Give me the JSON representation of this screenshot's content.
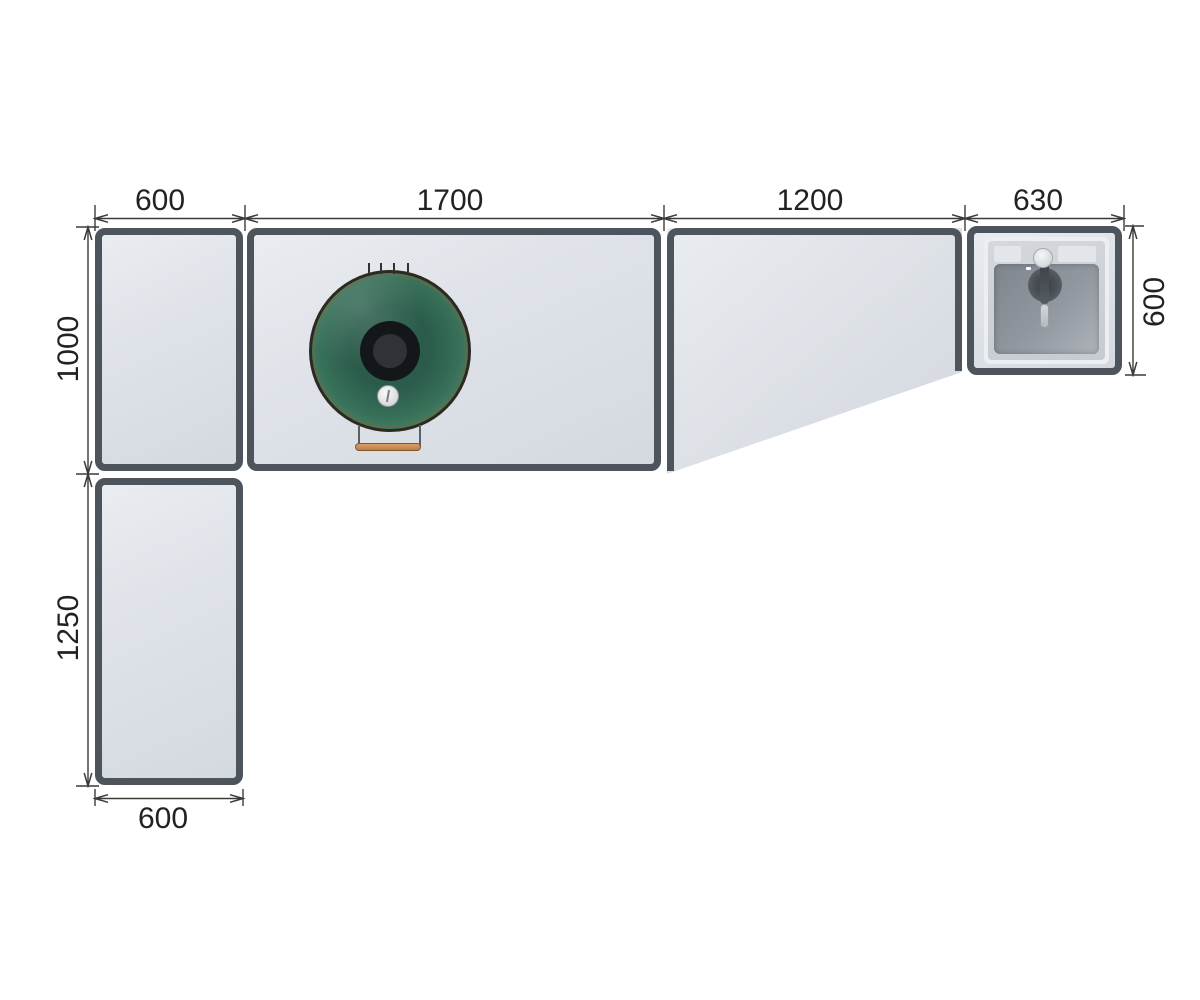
{
  "drawing": {
    "type": "outdoor-kitchen-plan-top-view",
    "background": "#ffffff",
    "dim_line_color": "#3a3a3a",
    "frame_color": "#4d545c",
    "surface_color": "#dfe3e9",
    "dimensions": {
      "top_corner_width": "600",
      "top_grill_module_width": "1700",
      "top_worktop_module_width": "1200",
      "top_sink_module_width": "630",
      "left_main_depth": "1000",
      "left_return_length": "1250",
      "right_sink_depth": "600",
      "bottom_return_width": "600"
    },
    "modules": [
      {
        "name": "corner cabinet",
        "width": "600",
        "depth": "1000"
      },
      {
        "name": "grill cabinet",
        "width": "1700",
        "depth": "1000",
        "appliance": "kamado grill"
      },
      {
        "name": "tapered worktop module",
        "width": "1200"
      },
      {
        "name": "sink cabinet",
        "width": "630",
        "depth": "600",
        "appliance": "sink with faucet"
      },
      {
        "name": "return cabinet",
        "width": "600",
        "length": "1250"
      }
    ],
    "grill": {
      "dome_color": "#2b5c4b",
      "vent_color": "#141719",
      "handle_color": "#c98a54"
    },
    "sink": {
      "basin_color": "#9298a0",
      "deck_color": "#ccd1d7"
    }
  }
}
